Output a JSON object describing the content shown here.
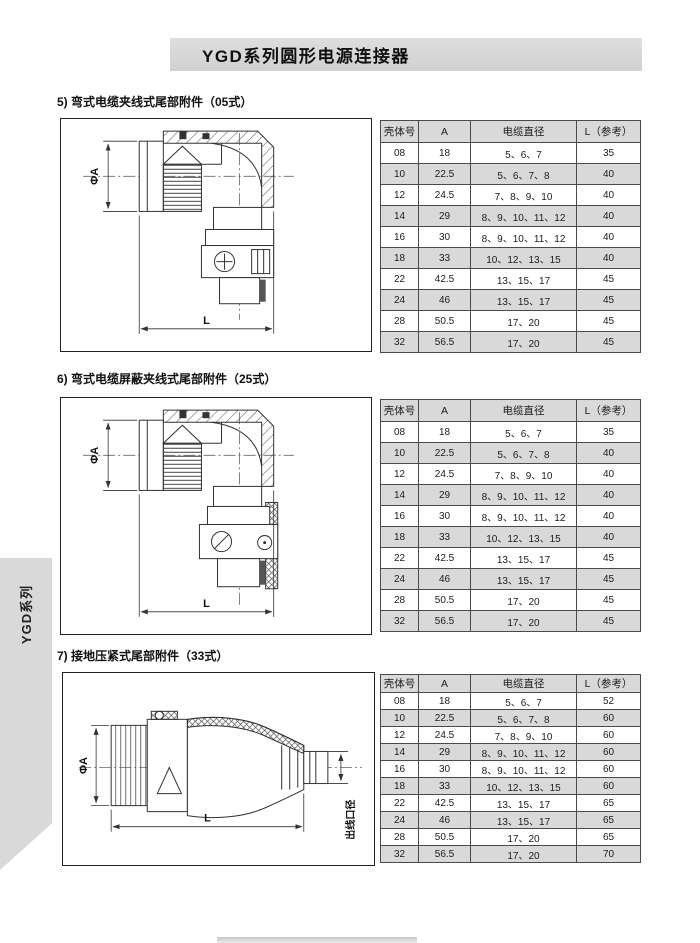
{
  "header": {
    "title": "YGD系列圆形电源连接器"
  },
  "side_tab": {
    "label": "YGD系列"
  },
  "table": {
    "headers": [
      "壳体号",
      "A",
      "电缆直径",
      "L（参考）"
    ]
  },
  "sections": [
    {
      "id": "05",
      "title": "5) 弯式电缆夹线式尾部附件（05式）",
      "drawing_labels": {
        "diameter": "ΦA",
        "length": "L"
      },
      "rows": [
        [
          "08",
          "18",
          "5、6、7",
          "35"
        ],
        [
          "10",
          "22.5",
          "5、6、7、8",
          "40"
        ],
        [
          "12",
          "24.5",
          "7、8、9、10",
          "40"
        ],
        [
          "14",
          "29",
          "8、9、10、11、12",
          "40"
        ],
        [
          "16",
          "30",
          "8、9、10、11、12",
          "40"
        ],
        [
          "18",
          "33",
          "10、12、13、15",
          "40"
        ],
        [
          "22",
          "42.5",
          "13、15、17",
          "45"
        ],
        [
          "24",
          "46",
          "13、15、17",
          "45"
        ],
        [
          "28",
          "50.5",
          "17、20",
          "45"
        ],
        [
          "32",
          "56.5",
          "17、20",
          "45"
        ]
      ]
    },
    {
      "id": "25",
      "title": "6) 弯式电缆屏蔽夹线式尾部附件（25式）",
      "drawing_labels": {
        "diameter": "ΦA",
        "length": "L"
      },
      "rows": [
        [
          "08",
          "18",
          "5、6、7",
          "35"
        ],
        [
          "10",
          "22.5",
          "5、6、7、8",
          "40"
        ],
        [
          "12",
          "24.5",
          "7、8、9、10",
          "40"
        ],
        [
          "14",
          "29",
          "8、9、10、11、12",
          "40"
        ],
        [
          "16",
          "30",
          "8、9、10、11、12",
          "40"
        ],
        [
          "18",
          "33",
          "10、12、13、15",
          "40"
        ],
        [
          "22",
          "42.5",
          "13、15、17",
          "45"
        ],
        [
          "24",
          "46",
          "13、15、17",
          "45"
        ],
        [
          "28",
          "50.5",
          "17、20",
          "45"
        ],
        [
          "32",
          "56.5",
          "17、20",
          "45"
        ]
      ]
    },
    {
      "id": "33",
      "title": "7) 接地压紧式尾部附件（33式）",
      "drawing_labels": {
        "diameter": "ΦA",
        "length": "L",
        "outlet": "出线口径"
      },
      "rows": [
        [
          "08",
          "18",
          "5、6、7",
          "52"
        ],
        [
          "10",
          "22.5",
          "5、6、7、8",
          "60"
        ],
        [
          "12",
          "24.5",
          "7、8、9、10",
          "60"
        ],
        [
          "14",
          "29",
          "8、9、10、11、12",
          "60"
        ],
        [
          "16",
          "30",
          "8、9、10、11、12",
          "60"
        ],
        [
          "18",
          "33",
          "10、12、13、15",
          "60"
        ],
        [
          "22",
          "42.5",
          "13、15、17",
          "65"
        ],
        [
          "24",
          "46",
          "13、15、17",
          "65"
        ],
        [
          "28",
          "50.5",
          "17、20",
          "65"
        ],
        [
          "32",
          "56.5",
          "17、20",
          "70"
        ]
      ]
    }
  ],
  "colors": {
    "band_gray": "#d6d6d6",
    "table_alt_row": "#d9d9d9",
    "line": "#333333"
  }
}
